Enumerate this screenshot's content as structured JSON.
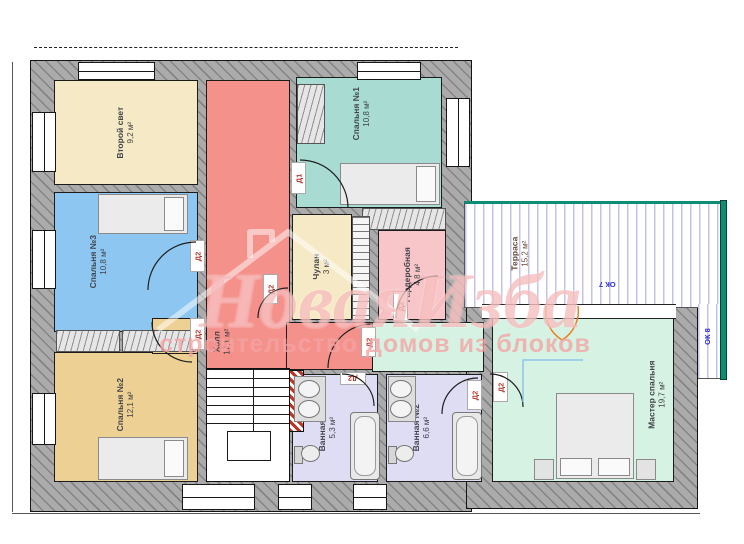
{
  "plan": {
    "watermark": {
      "title": "НоваяИзба",
      "subtitle": "строительство домов из блоков"
    },
    "rooms": [
      {
        "name": "Второй свет",
        "area": "9,2 м²",
        "color": "#f6e9c5"
      },
      {
        "name": "Спальня №3",
        "area": "10,8 м²",
        "color": "#8cc6f1"
      },
      {
        "name": "Спальня №2",
        "area": "12,1 м²",
        "color": "#edd093"
      },
      {
        "name": "Холл",
        "area": "17,1 м²",
        "color": "#f5918b"
      },
      {
        "name": "Чулан",
        "area": "3 м²",
        "color": "#f6e9c5"
      },
      {
        "name": "Спальня №1",
        "area": "10,8 м²",
        "color": "#a8dbd2"
      },
      {
        "name": "Гардеробная",
        "area": "4,8 м²",
        "color": "#f8c5c9"
      },
      {
        "name": "Терраса",
        "area": "15,2 м²",
        "color": "#ffffff"
      },
      {
        "name": "Ванная №1",
        "area": "5,3 м²",
        "color": "#dfddf4"
      },
      {
        "name": "Ванная №2",
        "area": "6,6 м²",
        "color": "#dfddf4"
      },
      {
        "name": "Мастер спальня",
        "area": "19,7 м²",
        "color": "#d6f2e2"
      }
    ],
    "door_labels": {
      "d1": "Д1",
      "d2": "Д2"
    },
    "window_labels": {
      "ok7": "ОК 7",
      "ok8": "ОК 8"
    },
    "palette": {
      "wall": "#ababab",
      "terrace_stripe": "#c3c3ea",
      "terrace_border": "#0d8d73",
      "door_text": "#b3372a",
      "window_text": "#2b2bd6"
    }
  }
}
